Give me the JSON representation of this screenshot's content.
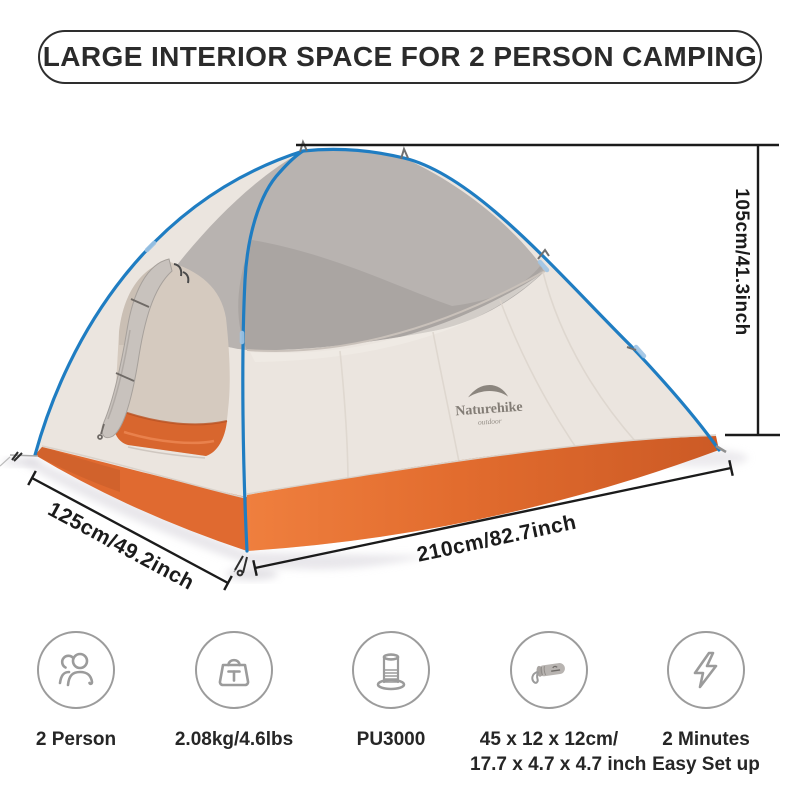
{
  "banner": {
    "title": "LARGE INTERIOR SPACE FOR 2 PERSON CAMPING"
  },
  "dimensions": {
    "height": "105cm/41.3inch",
    "width": "125cm/49.2inch",
    "length": "210cm/82.7inch"
  },
  "tent": {
    "brand": "Naturehike",
    "brand_sub": "outdoor",
    "colors": {
      "pole_blue": "#1f7dc2",
      "fly_light": "#ebe5df",
      "mesh_gray": "#b8b3b0",
      "skirt_orange": "#e06a30",
      "floor_orange": "#d8662e",
      "dimension_line": "#1b1b1b"
    }
  },
  "features": [
    {
      "icon": "two-person-icon",
      "lines": [
        "2 Person"
      ]
    },
    {
      "icon": "weight-icon",
      "lines": [
        "2.08kg/4.6lbs"
      ]
    },
    {
      "icon": "waterproof-rating-icon",
      "lines": [
        "PU3000"
      ]
    },
    {
      "icon": "packed-size-icon",
      "lines": [
        "45 x 12 x 12cm/",
        "17.7 x 4.7 x 4.7 inch"
      ]
    },
    {
      "icon": "quick-setup-icon",
      "lines": [
        "2 Minutes",
        "Easy Set up"
      ]
    }
  ],
  "ui_colors": {
    "icon_gray": "#9b9b9b",
    "banner_border": "#2e2e2e",
    "label_text": "#262626"
  }
}
